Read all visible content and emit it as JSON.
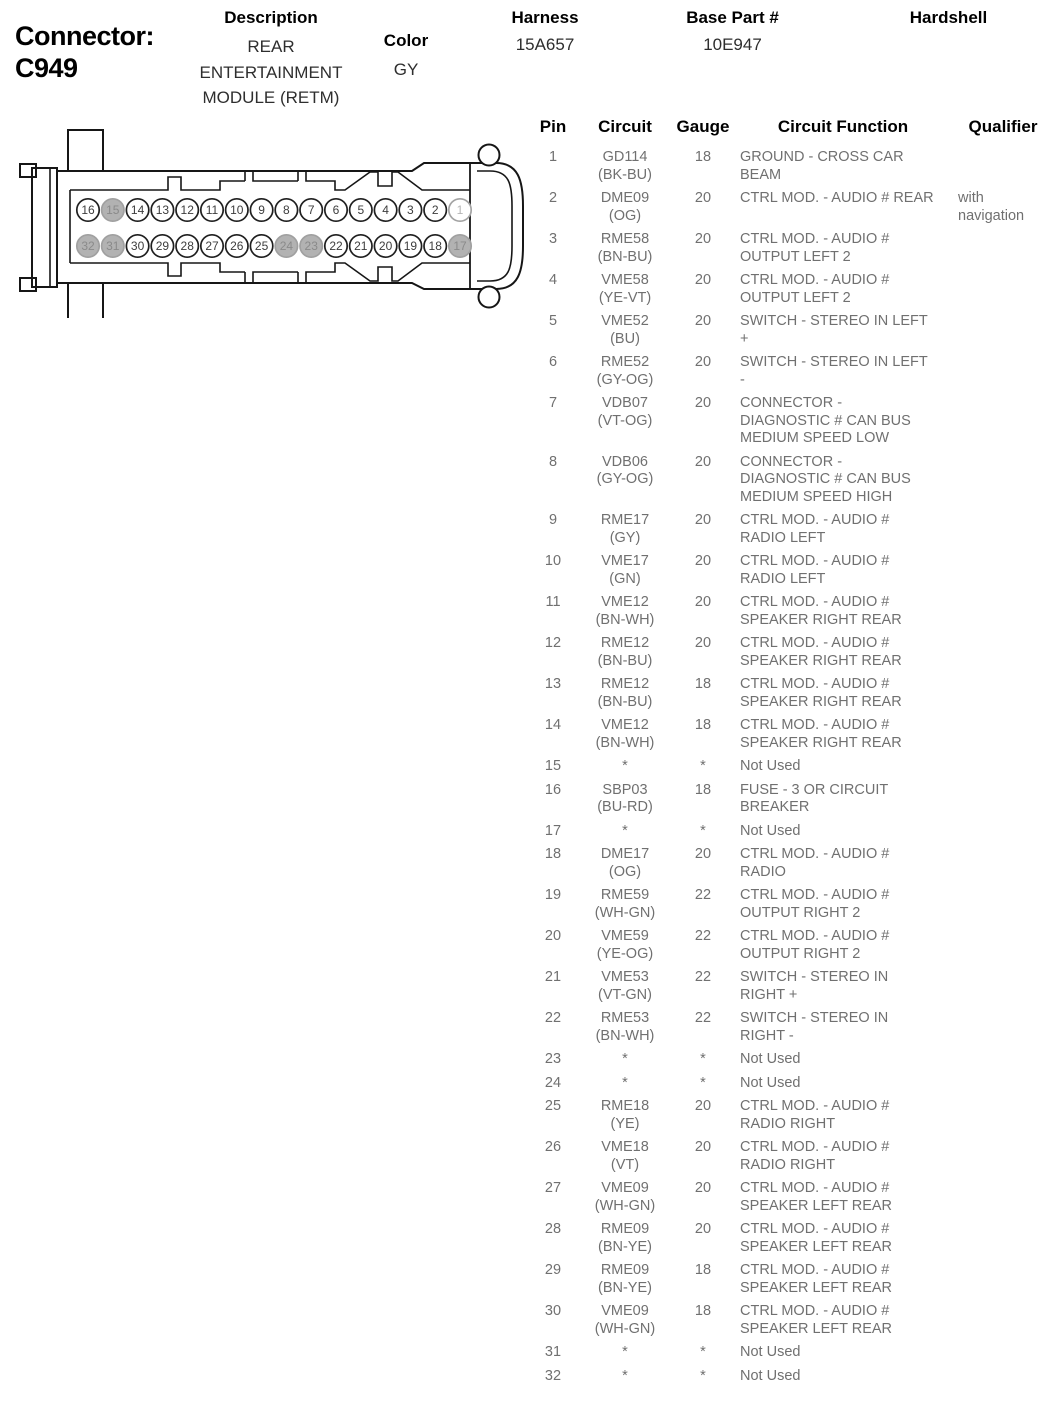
{
  "header": {
    "connector_label": "Connector:",
    "connector_id": "C949",
    "description_label": "Description",
    "description_value": "REAR\nENTERTAINMENT\nMODULE (RETM)",
    "color_label": "Color",
    "color_value": "GY",
    "harness_label": "Harness",
    "harness_value": "15A657",
    "base_part_label": "Base Part #",
    "base_part_value": "10E947",
    "hardshell_label": "Hardshell",
    "hardshell_value": ""
  },
  "diagram": {
    "top_row_pins": [
      16,
      15,
      14,
      13,
      12,
      11,
      10,
      9,
      8,
      7,
      6,
      5,
      4,
      3,
      2,
      1
    ],
    "bottom_row_pins": [
      32,
      31,
      30,
      29,
      28,
      27,
      26,
      25,
      24,
      23,
      22,
      21,
      20,
      19,
      18,
      17
    ],
    "unused_pins": [
      15,
      17,
      23,
      24,
      31,
      32
    ],
    "faded_pins": [
      1
    ],
    "colors": {
      "line": "#161616",
      "used_fill": "#ffffff",
      "used_stroke": "#1f1f1f",
      "used_text": "#3d3d3d",
      "unused_fill": "#b2b2b2",
      "unused_stroke": "#a0a0a0",
      "unused_text": "#8a8a8a",
      "faded_stroke": "#a3a3a3",
      "faded_text": "#b5b5b5"
    }
  },
  "table": {
    "headers": [
      "Pin",
      "Circuit",
      "Gauge",
      "Circuit Function",
      "Qualifier"
    ],
    "rows": [
      {
        "pin": "1",
        "circuit": "GD114\n(BK-BU)",
        "gauge": "18",
        "func": "GROUND - CROSS CAR\nBEAM",
        "qual": ""
      },
      {
        "pin": "2",
        "circuit": "DME09\n(OG)",
        "gauge": "20",
        "func": "CTRL MOD. - AUDIO # REAR",
        "qual": "with\nnavigation"
      },
      {
        "pin": "3",
        "circuit": "RME58\n(BN-BU)",
        "gauge": "20",
        "func": "CTRL MOD. - AUDIO #\nOUTPUT LEFT 2",
        "qual": ""
      },
      {
        "pin": "4",
        "circuit": "VME58\n(YE-VT)",
        "gauge": "20",
        "func": "CTRL MOD. - AUDIO #\nOUTPUT LEFT 2",
        "qual": ""
      },
      {
        "pin": "5",
        "circuit": "VME52\n(BU)",
        "gauge": "20",
        "func": "SWITCH - STEREO IN LEFT\n+",
        "qual": ""
      },
      {
        "pin": "6",
        "circuit": "RME52\n(GY-OG)",
        "gauge": "20",
        "func": "SWITCH - STEREO IN LEFT\n-",
        "qual": ""
      },
      {
        "pin": "7",
        "circuit": "VDB07\n(VT-OG)",
        "gauge": "20",
        "func": "CONNECTOR -\nDIAGNOSTIC # CAN BUS\nMEDIUM SPEED LOW",
        "qual": ""
      },
      {
        "pin": "8",
        "circuit": "VDB06\n(GY-OG)",
        "gauge": "20",
        "func": "CONNECTOR -\nDIAGNOSTIC # CAN BUS\nMEDIUM SPEED HIGH",
        "qual": ""
      },
      {
        "pin": "9",
        "circuit": "RME17\n(GY)",
        "gauge": "20",
        "func": "CTRL MOD. - AUDIO #\nRADIO LEFT",
        "qual": ""
      },
      {
        "pin": "10",
        "circuit": "VME17\n(GN)",
        "gauge": "20",
        "func": "CTRL MOD. - AUDIO #\nRADIO LEFT",
        "qual": ""
      },
      {
        "pin": "11",
        "circuit": "VME12\n(BN-WH)",
        "gauge": "20",
        "func": "CTRL MOD. - AUDIO #\nSPEAKER RIGHT REAR",
        "qual": ""
      },
      {
        "pin": "12",
        "circuit": "RME12\n(BN-BU)",
        "gauge": "20",
        "func": "CTRL MOD. - AUDIO #\nSPEAKER RIGHT REAR",
        "qual": ""
      },
      {
        "pin": "13",
        "circuit": "RME12\n(BN-BU)",
        "gauge": "18",
        "func": "CTRL MOD. - AUDIO #\nSPEAKER RIGHT REAR",
        "qual": ""
      },
      {
        "pin": "14",
        "circuit": "VME12\n(BN-WH)",
        "gauge": "18",
        "func": "CTRL MOD. - AUDIO #\nSPEAKER RIGHT REAR",
        "qual": ""
      },
      {
        "pin": "15",
        "circuit": "*",
        "gauge": "*",
        "func": "Not Used",
        "qual": ""
      },
      {
        "pin": "16",
        "circuit": "SBP03\n(BU-RD)",
        "gauge": "18",
        "func": "FUSE - 3 OR CIRCUIT\nBREAKER",
        "qual": ""
      },
      {
        "pin": "17",
        "circuit": "*",
        "gauge": "*",
        "func": "Not Used",
        "qual": ""
      },
      {
        "pin": "18",
        "circuit": "DME17\n(OG)",
        "gauge": "20",
        "func": "CTRL MOD. - AUDIO #\nRADIO",
        "qual": ""
      },
      {
        "pin": "19",
        "circuit": "RME59\n(WH-GN)",
        "gauge": "22",
        "func": "CTRL MOD. - AUDIO #\nOUTPUT RIGHT 2",
        "qual": ""
      },
      {
        "pin": "20",
        "circuit": "VME59\n(YE-OG)",
        "gauge": "22",
        "func": "CTRL MOD. - AUDIO #\nOUTPUT RIGHT 2",
        "qual": ""
      },
      {
        "pin": "21",
        "circuit": "VME53\n(VT-GN)",
        "gauge": "22",
        "func": "SWITCH - STEREO IN\nRIGHT +",
        "qual": ""
      },
      {
        "pin": "22",
        "circuit": "RME53\n(BN-WH)",
        "gauge": "22",
        "func": "SWITCH - STEREO IN\nRIGHT -",
        "qual": ""
      },
      {
        "pin": "23",
        "circuit": "*",
        "gauge": "*",
        "func": "Not Used",
        "qual": ""
      },
      {
        "pin": "24",
        "circuit": "*",
        "gauge": "*",
        "func": "Not Used",
        "qual": ""
      },
      {
        "pin": "25",
        "circuit": "RME18\n(YE)",
        "gauge": "20",
        "func": "CTRL MOD. - AUDIO #\nRADIO RIGHT",
        "qual": ""
      },
      {
        "pin": "26",
        "circuit": "VME18\n(VT)",
        "gauge": "20",
        "func": "CTRL MOD. - AUDIO #\nRADIO RIGHT",
        "qual": ""
      },
      {
        "pin": "27",
        "circuit": "VME09\n(WH-GN)",
        "gauge": "20",
        "func": "CTRL MOD. - AUDIO #\nSPEAKER LEFT REAR",
        "qual": ""
      },
      {
        "pin": "28",
        "circuit": "RME09\n(BN-YE)",
        "gauge": "20",
        "func": "CTRL MOD. - AUDIO #\nSPEAKER LEFT REAR",
        "qual": ""
      },
      {
        "pin": "29",
        "circuit": "RME09\n(BN-YE)",
        "gauge": "18",
        "func": "CTRL MOD. - AUDIO #\nSPEAKER LEFT REAR",
        "qual": ""
      },
      {
        "pin": "30",
        "circuit": "VME09\n(WH-GN)",
        "gauge": "18",
        "func": "CTRL MOD. - AUDIO #\nSPEAKER LEFT REAR",
        "qual": ""
      },
      {
        "pin": "31",
        "circuit": "*",
        "gauge": "*",
        "func": "Not Used",
        "qual": ""
      },
      {
        "pin": "32",
        "circuit": "*",
        "gauge": "*",
        "func": "Not Used",
        "qual": ""
      }
    ]
  }
}
